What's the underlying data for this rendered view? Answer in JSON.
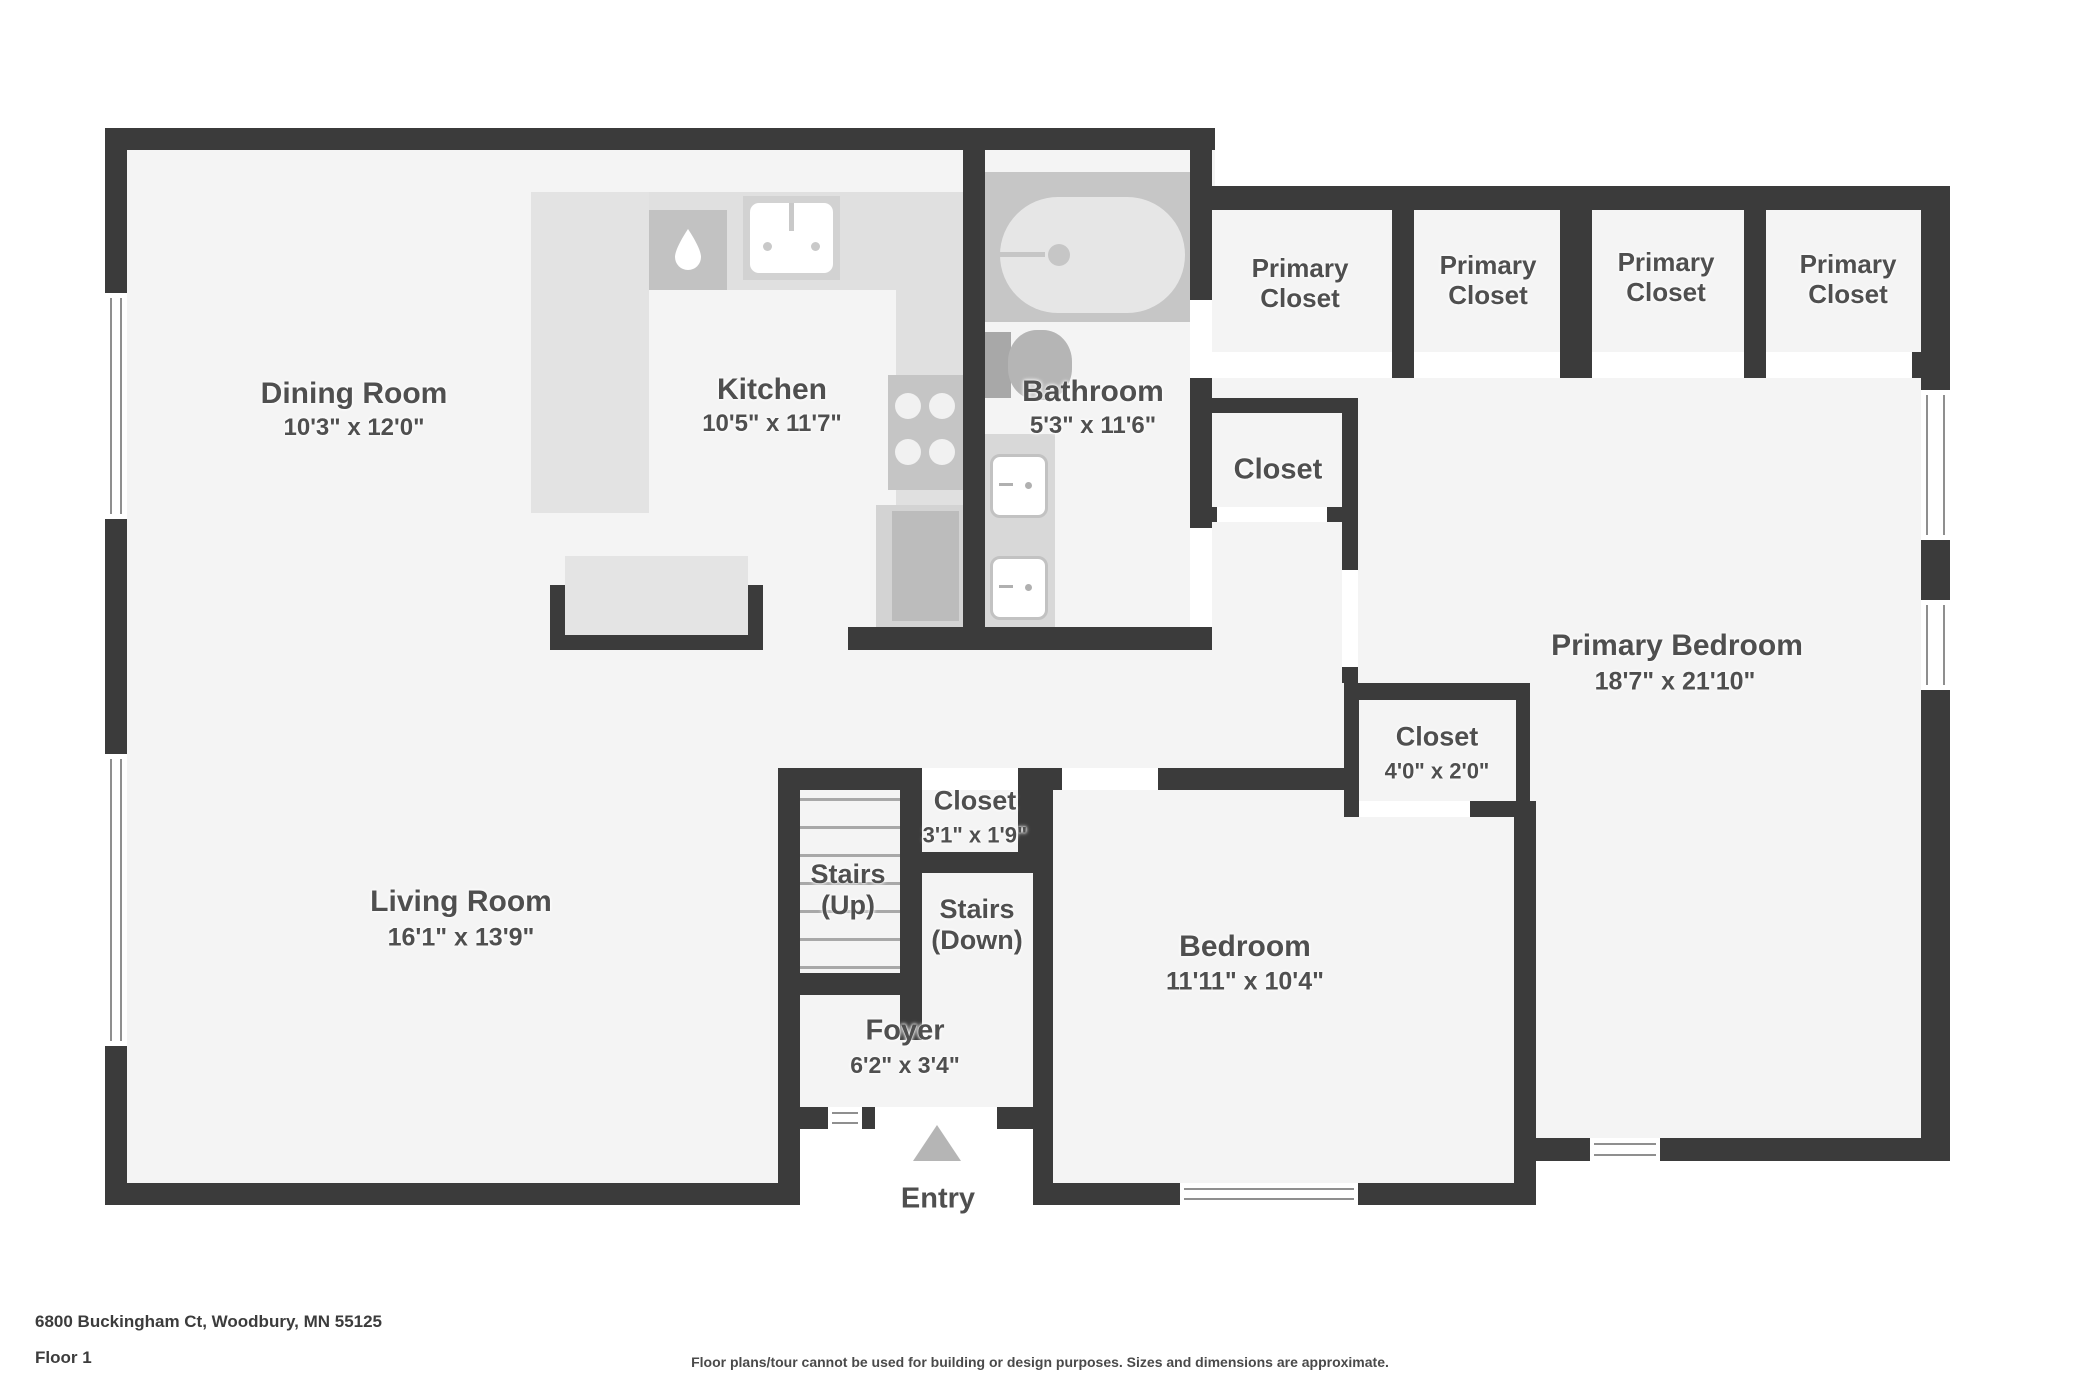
{
  "meta": {
    "address": "6800 Buckingham Ct, Woodbury, MN 55125",
    "floor_label": "Floor 1",
    "disclaimer": "Floor plans/tour cannot be used for building or design purposes. Sizes and dimensions are approximate."
  },
  "rooms": {
    "dining": {
      "name": "Dining Room",
      "dims": "10'3\" x 12'0\""
    },
    "kitchen": {
      "name": "Kitchen",
      "dims": "10'5\" x 11'7\""
    },
    "bathroom": {
      "name": "Bathroom",
      "dims": "5'3\" x 11'6\""
    },
    "living": {
      "name": "Living Room",
      "dims": "16'1\" x 13'9\""
    },
    "bedroom": {
      "name": "Bedroom",
      "dims": "11'11\" x 10'4\""
    },
    "primary_bedroom": {
      "name": "Primary Bedroom",
      "dims": "18'7\" x 21'10\""
    },
    "foyer": {
      "name": "Foyer",
      "dims": "6'2\" x 3'4\""
    },
    "entry": {
      "name": "Entry"
    },
    "closet_hall": {
      "name": "Closet"
    },
    "closet_primary": {
      "name": "Closet",
      "dims": "4'0\" x 2'0\""
    },
    "closet_entry": {
      "name": "Closet",
      "dims": "3'1\" x 1'9\""
    },
    "stairs_up": {
      "line1": "Stairs",
      "line2": "(Up)"
    },
    "stairs_down": {
      "line1": "Stairs",
      "line2": "(Down)"
    }
  },
  "primary_closets": [
    "Primary Closet",
    "Primary Closet",
    "Primary Closet",
    "Primary Closet"
  ],
  "icons": {
    "entry_arrow_icon": "triangle-up",
    "water_drop_icon": "drop",
    "kitchen_sink_icon": "sink",
    "stove_icon": "4-burner-stove",
    "bathtub_icon": "bathtub",
    "toilet_icon": "toilet",
    "vanity_sink_icon": "sink"
  },
  "colors": {
    "wall": "#3b3b3b",
    "floor": "#f4f4f4",
    "label": "#4f4f4f",
    "counter": "#e3e3e3",
    "fixture": "#c6c6c6",
    "winline": "#8f8f8f",
    "entry": "#b5b5b5"
  }
}
